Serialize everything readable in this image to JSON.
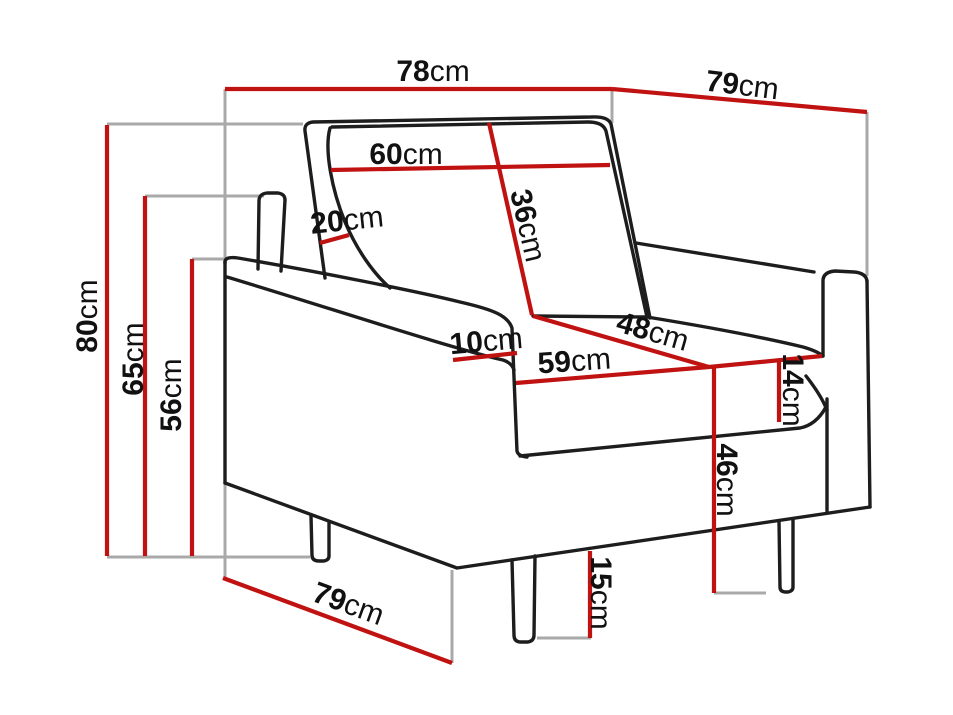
{
  "diagram": {
    "subject": "armchair-dimensions",
    "colors": {
      "dimension_line": "#c11212",
      "guide_line": "#a9a9a9",
      "outline": "#1d1d1d",
      "label_text": "#111111",
      "background": "#ffffff"
    }
  },
  "measurements": [
    {
      "id": "overall-width",
      "value": "78",
      "unit": "cm"
    },
    {
      "id": "overall-depth-top",
      "value": "79",
      "unit": "cm"
    },
    {
      "id": "backrest-cushion-width",
      "value": "60",
      "unit": "cm"
    },
    {
      "id": "backrest-thickness",
      "value": "20",
      "unit": "cm"
    },
    {
      "id": "backrest-cushion-height",
      "value": "36",
      "unit": "cm"
    },
    {
      "id": "overall-height",
      "value": "80",
      "unit": "cm"
    },
    {
      "id": "back-panel-height",
      "value": "65",
      "unit": "cm"
    },
    {
      "id": "armrest-height",
      "value": "56",
      "unit": "cm"
    },
    {
      "id": "armrest-width",
      "value": "10",
      "unit": "cm"
    },
    {
      "id": "seat-depth",
      "value": "48",
      "unit": "cm"
    },
    {
      "id": "seat-width",
      "value": "59",
      "unit": "cm"
    },
    {
      "id": "seat-cushion-thickness",
      "value": "14",
      "unit": "cm"
    },
    {
      "id": "seat-height",
      "value": "46",
      "unit": "cm"
    },
    {
      "id": "leg-height",
      "value": "15",
      "unit": "cm"
    },
    {
      "id": "overall-depth-bottom",
      "value": "79",
      "unit": "cm"
    }
  ]
}
